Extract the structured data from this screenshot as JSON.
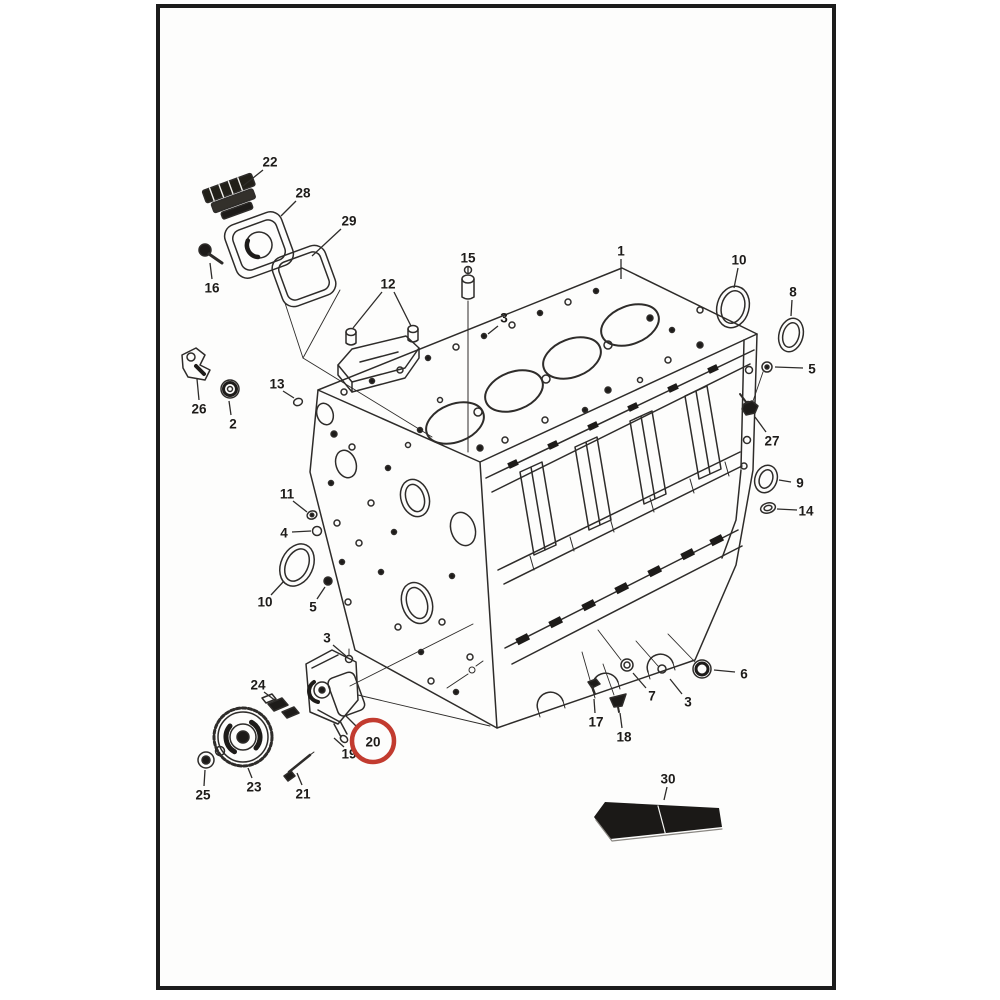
{
  "page": {
    "width": 1000,
    "height": 1000,
    "background": "#ffffff",
    "frame": {
      "x": 158,
      "y": 6,
      "width": 676,
      "height": 982,
      "border_color": "#1c1c1c",
      "border_width": 4
    }
  },
  "palette": {
    "line": "#2e2c2a",
    "dark": "#1d1b19",
    "paper": "#fdfdfc",
    "highlight_red": "#c23b2f"
  },
  "diagram": {
    "type": "exploded-parts-diagram",
    "subject": "engine cylinder block assembly",
    "highlight": {
      "label": "20",
      "cx": 373,
      "cy": 741,
      "r": 21,
      "color": "#c23b2f",
      "stroke_width": 4.5
    },
    "callouts": [
      {
        "label": "22",
        "x": 270,
        "y": 162,
        "leader": [
          [
            263,
            170
          ],
          [
            243,
            186
          ]
        ]
      },
      {
        "label": "28",
        "x": 303,
        "y": 193,
        "leader": [
          [
            296,
            201
          ],
          [
            281,
            216
          ]
        ]
      },
      {
        "label": "29",
        "x": 349,
        "y": 221,
        "leader": [
          [
            341,
            229
          ],
          [
            312,
            256
          ]
        ]
      },
      {
        "label": "16",
        "x": 212,
        "y": 288,
        "leader": [
          [
            212,
            279
          ],
          [
            210,
            263
          ]
        ]
      },
      {
        "label": "26",
        "x": 199,
        "y": 409,
        "leader": [
          [
            199,
            400
          ],
          [
            197,
            379
          ]
        ]
      },
      {
        "label": "2",
        "x": 233,
        "y": 424,
        "leader": [
          [
            231,
            415
          ],
          [
            229,
            401
          ]
        ]
      },
      {
        "label": "13",
        "x": 277,
        "y": 384,
        "leader": [
          [
            283,
            391
          ],
          [
            294,
            398
          ]
        ]
      },
      {
        "label": "12",
        "x": 388,
        "y": 284,
        "leader": [
          [
            382,
            292
          ],
          [
            353,
            328
          ]
        ],
        "leader2": [
          [
            394,
            292
          ],
          [
            411,
            326
          ]
        ]
      },
      {
        "label": "15",
        "x": 468,
        "y": 258,
        "leader": [
          [
            468,
            266
          ],
          [
            468,
            273
          ]
        ]
      },
      {
        "label": "1",
        "x": 621,
        "y": 251,
        "leader": [
          [
            621,
            259
          ],
          [
            621,
            279
          ]
        ]
      },
      {
        "label": "10",
        "x": 739,
        "y": 260,
        "leader": [
          [
            738,
            268
          ],
          [
            734,
            288
          ]
        ]
      },
      {
        "label": "8",
        "x": 793,
        "y": 292,
        "leader": [
          [
            792,
            300
          ],
          [
            791,
            316
          ]
        ]
      },
      {
        "label": "5",
        "x": 812,
        "y": 369,
        "leader": [
          [
            803,
            368
          ],
          [
            775,
            367
          ]
        ]
      },
      {
        "label": "27",
        "x": 772,
        "y": 441,
        "leader": [
          [
            766,
            432
          ],
          [
            755,
            417
          ]
        ]
      },
      {
        "label": "9",
        "x": 800,
        "y": 483,
        "leader": [
          [
            791,
            482
          ],
          [
            779,
            480
          ]
        ]
      },
      {
        "label": "14",
        "x": 806,
        "y": 511,
        "leader": [
          [
            797,
            510
          ],
          [
            777,
            509
          ]
        ]
      },
      {
        "label": "11",
        "x": 287,
        "y": 494,
        "leader": [
          [
            293,
            501
          ],
          [
            307,
            512
          ]
        ]
      },
      {
        "label": "4",
        "x": 284,
        "y": 533,
        "leader": [
          [
            292,
            532
          ],
          [
            311,
            531
          ]
        ]
      },
      {
        "label": "10",
        "x": 265,
        "y": 602,
        "leader": [
          [
            271,
            595
          ],
          [
            284,
            581
          ]
        ]
      },
      {
        "label": "5",
        "x": 313,
        "y": 607,
        "leader": [
          [
            317,
            599
          ],
          [
            325,
            587
          ]
        ]
      },
      {
        "label": "3",
        "x": 327,
        "y": 638,
        "leader": [
          [
            333,
            645
          ],
          [
            346,
            656
          ]
        ]
      },
      {
        "label": "3",
        "x": 504,
        "y": 318,
        "leader": [
          [
            498,
            326
          ],
          [
            488,
            334
          ]
        ]
      },
      {
        "label": "24",
        "x": 258,
        "y": 685,
        "leader": [
          [
            264,
            692
          ],
          [
            276,
            701
          ]
        ]
      },
      {
        "label": "19",
        "x": 349,
        "y": 754,
        "leader": [
          [
            344,
            747
          ],
          [
            334,
            738
          ]
        ]
      },
      {
        "label": "20",
        "x": 373,
        "y": 742,
        "circled": true,
        "leader": [
          [
            357,
            727
          ],
          [
            346,
            716
          ]
        ]
      },
      {
        "label": "21",
        "x": 303,
        "y": 794,
        "leader": [
          [
            302,
            785
          ],
          [
            297,
            773
          ]
        ]
      },
      {
        "label": "23",
        "x": 254,
        "y": 787,
        "leader": [
          [
            252,
            778
          ],
          [
            248,
            768
          ]
        ]
      },
      {
        "label": "25",
        "x": 203,
        "y": 795,
        "leader": [
          [
            204,
            786
          ],
          [
            205,
            770
          ]
        ]
      },
      {
        "label": "17",
        "x": 596,
        "y": 722,
        "leader": [
          [
            595,
            713
          ],
          [
            594,
            699
          ]
        ]
      },
      {
        "label": "18",
        "x": 624,
        "y": 737,
        "leader": [
          [
            622,
            728
          ],
          [
            620,
            713
          ]
        ]
      },
      {
        "label": "7",
        "x": 652,
        "y": 696,
        "leader": [
          [
            646,
            688
          ],
          [
            633,
            673
          ]
        ]
      },
      {
        "label": "3",
        "x": 688,
        "y": 702,
        "leader": [
          [
            682,
            694
          ],
          [
            670,
            679
          ]
        ]
      },
      {
        "label": "6",
        "x": 744,
        "y": 674,
        "leader": [
          [
            735,
            672
          ],
          [
            714,
            670
          ]
        ]
      },
      {
        "label": "30",
        "x": 668,
        "y": 779,
        "leader": [
          [
            667,
            787
          ],
          [
            664,
            800
          ]
        ]
      }
    ]
  }
}
